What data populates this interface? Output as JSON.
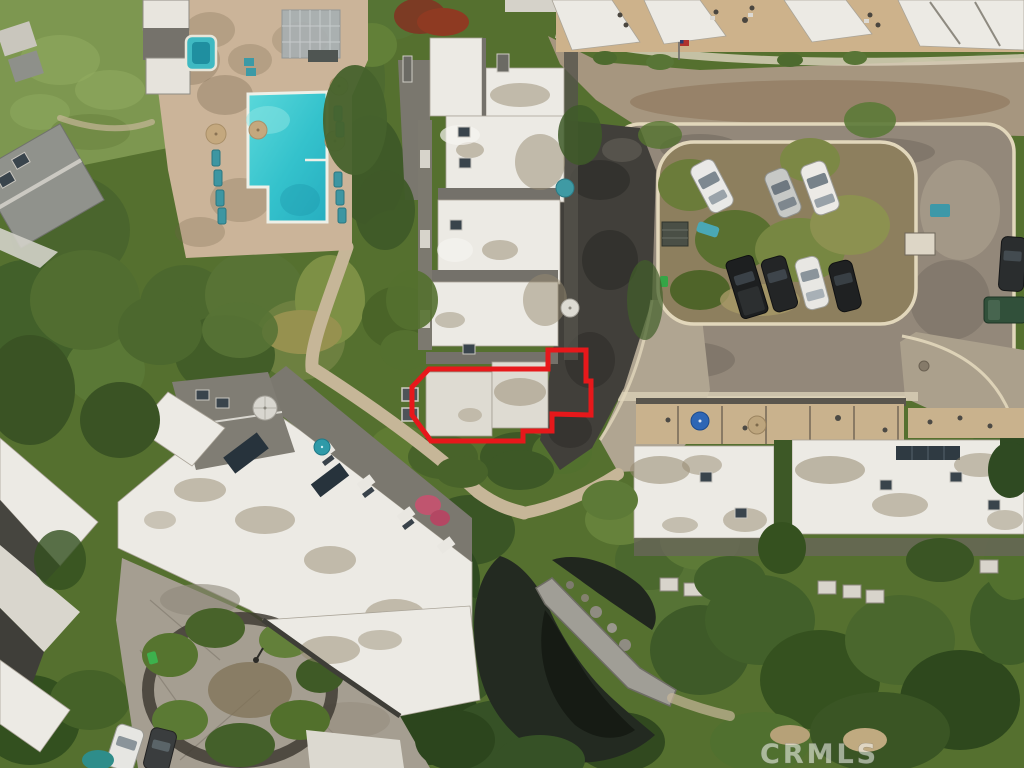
{
  "image": {
    "type": "aerial-drone-photograph",
    "subject": "condominium complex overhead view with one unit outlined",
    "width_px": 1024,
    "height_px": 768
  },
  "watermark": {
    "text": "CRMLS"
  },
  "highlight": {
    "label": "outlined-subject-unit",
    "style": "red-polygon-outline",
    "color": "#e7181b"
  },
  "colors": {
    "highlight_red": "#e7181b",
    "pool_water": "#3cc9d2",
    "spa_water": "#3fb9c2",
    "pool_deck": "#cbb499",
    "roof_white": "#eceae4",
    "roof_shingle": "#7b786f",
    "asphalt": "#93887a",
    "curb": "#e2d7bb",
    "road": "#a6967f",
    "concrete": "#a59e91",
    "pond": "#232a21",
    "foliage_dark": "#3a5524",
    "foliage_mid": "#56742f",
    "foliage_light": "#7f9a48",
    "watermark": "#ffffff"
  },
  "scene": {
    "amenities": [
      "l-shaped-swimming-pool",
      "spa",
      "pergola",
      "pond",
      "stone-footbridge",
      "cul-de-sac"
    ],
    "buildings": [
      "central-condo-building",
      "top-right-townhomes",
      "bottom-left-condo-building",
      "bottom-right-condo-building",
      "left-edge-house"
    ],
    "vehicles": {
      "parking_top_row": [
        "white-suv",
        "silver-sedan",
        "white-suv"
      ],
      "parking_bottom_row": [
        "black-pickup",
        "black-suv",
        "white-sedan",
        "black-sedan"
      ],
      "right_edge": [
        "dark-suv",
        "green-truck"
      ],
      "culdesac_corner": [
        "white-car",
        "gray-car"
      ]
    },
    "umbrellas": {
      "pool_deck": 4,
      "bottom_left_patio": [
        "white",
        "teal"
      ],
      "bottom_right_patio": [
        "blue",
        "tan"
      ],
      "central_courtyard": [
        "teal",
        "white"
      ]
    },
    "flag": "us-flag"
  }
}
